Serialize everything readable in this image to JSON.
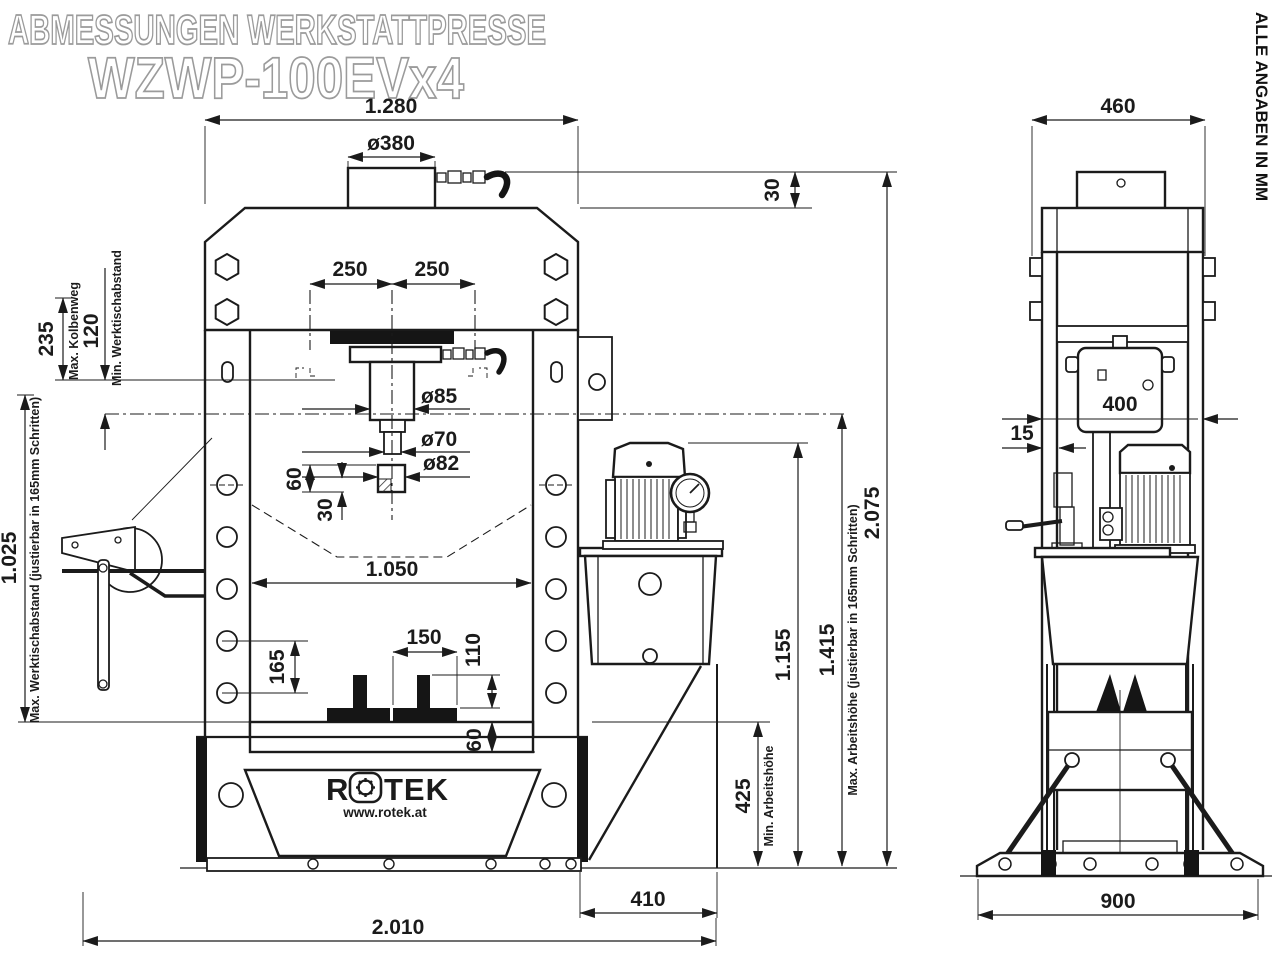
{
  "title": {
    "line1": "ABMESSUNGEN WERKSTATTPRESSE",
    "line2": "WZWP-100EVx4"
  },
  "note": "ALLE ANGABEN IN MM",
  "logo": {
    "brand_r": "R",
    "brand_tek": "TEK",
    "url": "www.rotek.at"
  },
  "colors": {
    "line": "#1b1b1b",
    "title_outline": "#9b9b9b",
    "background": "#ffffff"
  },
  "front_view": {
    "dims": {
      "overall_width": "1.280",
      "cylinder_top_dia": "ø380",
      "hose_clearance": "30",
      "center_left": "250",
      "center_right": "250",
      "piston_stroke": "235",
      "piston_stroke_label": "Max. Kolbenweg",
      "min_table_distance": "120",
      "min_table_distance_label": "Min. Werktischabstand",
      "max_table_distance": "1.025",
      "max_table_distance_label": "Max. Werktischabstand (justierbar in 165mm Schritten)",
      "piston_dia": "ø85",
      "rod_dia": "ø70",
      "adapter_dia": "ø82",
      "adapter_height": "60",
      "adapter_hatch_height": "30",
      "inner_width": "1.050",
      "hole_pitch": "165",
      "prism_spacing": "150",
      "prism_height": "110",
      "table_thickness": "60",
      "min_working_height": "425",
      "min_working_height_label": "Min. Arbeitshöhe",
      "pump_top_height": "1.155",
      "max_working_height": "1.415",
      "max_working_height_label": "Max. Arbeitshöhe (justierbar in 165mm Schritten)",
      "total_height": "2.075",
      "pump_overhang": "410",
      "total_width": "2.010"
    }
  },
  "side_view": {
    "dims": {
      "top_width": "460",
      "cylinder_unit_width": "400",
      "plate_gap": "15",
      "base_width": "900"
    }
  }
}
